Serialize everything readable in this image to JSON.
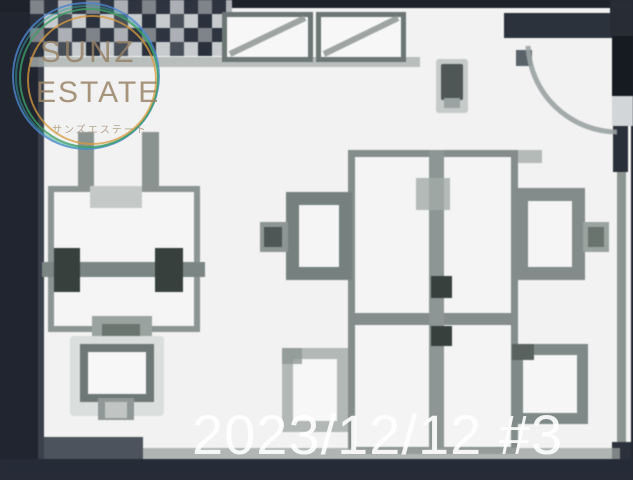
{
  "watermark": {
    "brand_line1": "SUNZ",
    "brand_line2": "ESTATE",
    "brand_line_jp": "サンズエステート",
    "ring_colors": [
      "#4c86cf",
      "#3f9e66",
      "#d79a3f",
      "#38a6a0"
    ],
    "text_color": "#96806a"
  },
  "date_overlay": {
    "text": "2023/12/12 #3",
    "color": "#ffffff"
  },
  "floor_plan": {
    "symbols": [
      "tiled-entrance-area",
      "window-with-cross",
      "window-with-cross",
      "door-swing-arc",
      "wall-panel",
      "desk-with-monitors",
      "meeting-table-island",
      "office-chairs"
    ],
    "colors": {
      "background_dark": "#232833",
      "floor_white": "#f1f2f1",
      "line_gray": "#7f8987",
      "furniture_dark": "#37403d"
    }
  }
}
